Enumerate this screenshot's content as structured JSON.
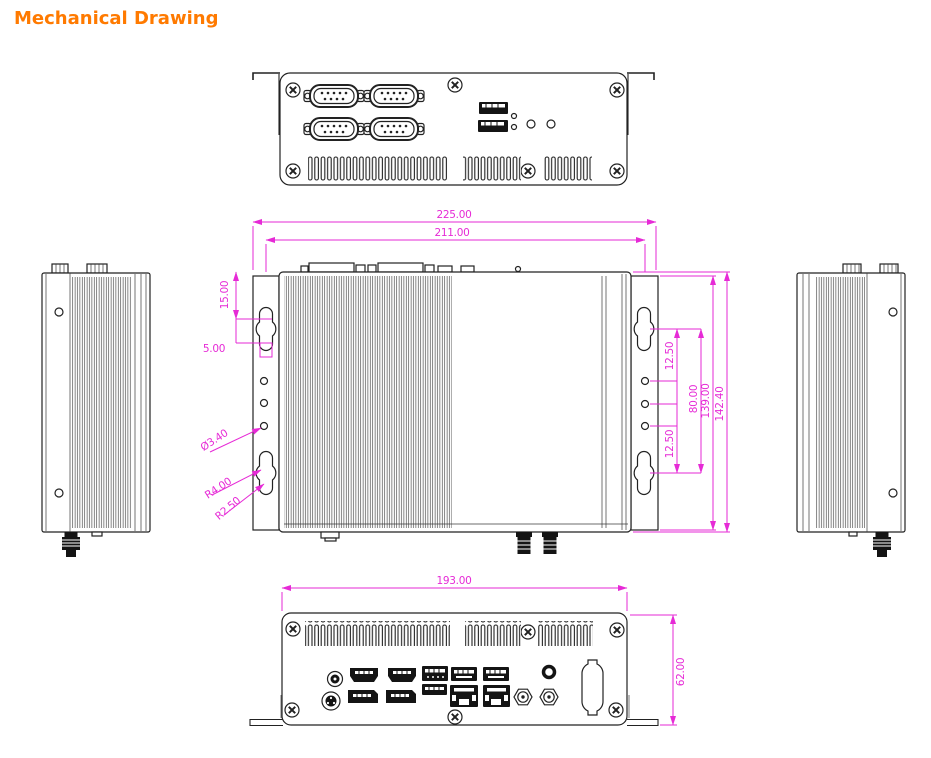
{
  "title": "Mechanical Drawing",
  "colors": {
    "title": "#ff7a00",
    "dimension": "#e62ad6",
    "line": "#222222"
  },
  "dims": {
    "overall_width": "225.00",
    "inner_width": "211.00",
    "bracket_top": "15.00",
    "slot_offset": "5.00",
    "hole_diameter": "Ø3.40",
    "slot_radius_outer": "R4.00",
    "slot_radius_inner": "R2.50",
    "hole_pitch_top": "12.50",
    "slot_pitch": "80.00",
    "mount_height": "139.00",
    "overall_height": "142.40",
    "hole_pitch_bottom": "12.50",
    "rear_width": "193.00",
    "rear_height": "62.00"
  }
}
